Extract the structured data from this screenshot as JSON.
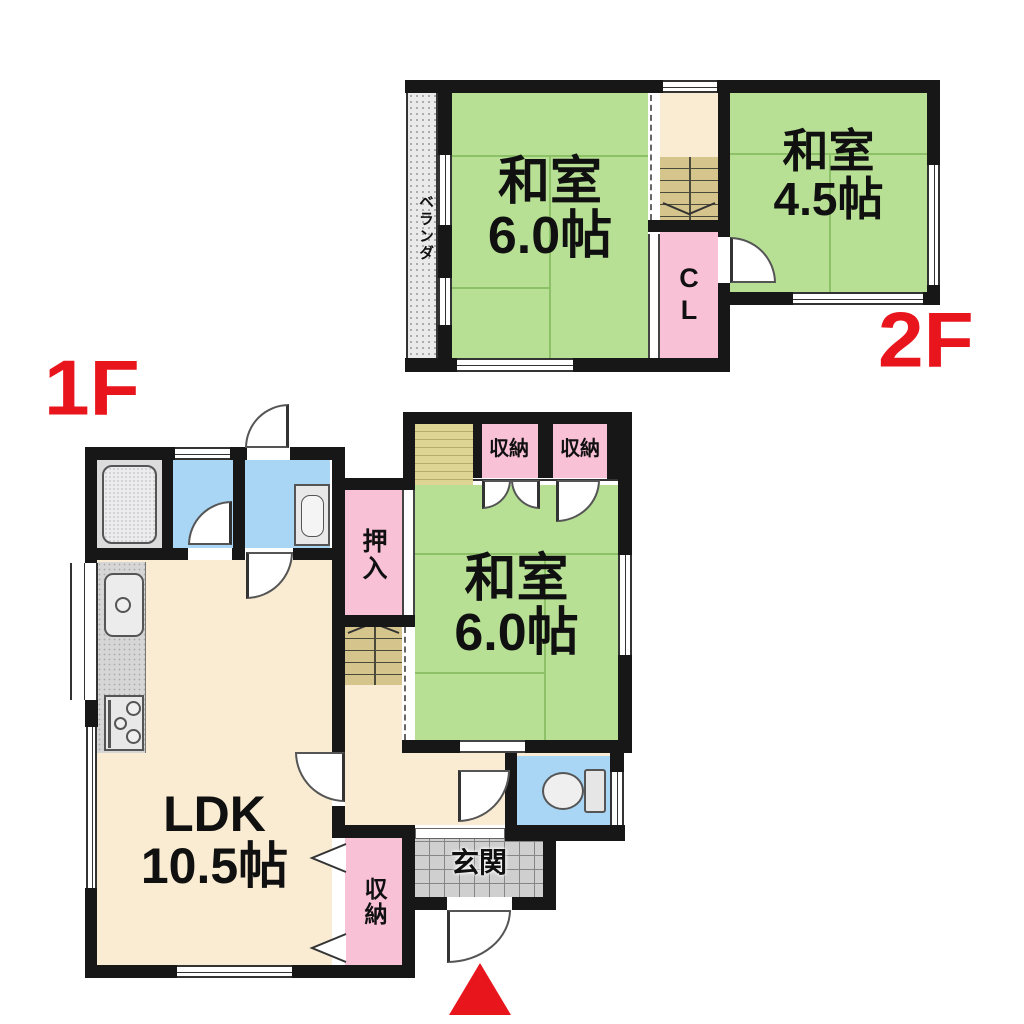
{
  "title": "戸建て間取り図 (detached house floor plan)",
  "floor2": {
    "label": "2F",
    "washitsu6": {
      "name": "和室",
      "size": "6.0帖"
    },
    "washitsu45": {
      "name": "和室",
      "size": "4.5帖"
    },
    "closet_label": "CL",
    "veranda_label": "ベランダ"
  },
  "floor1": {
    "label": "1F",
    "ldk": {
      "name": "LDK",
      "size": "10.5帖"
    },
    "washitsu6": {
      "name": "和室",
      "size": "6.0帖"
    },
    "oshiire_label": "押入",
    "storage_top_left": "収納",
    "storage_top_right": "収納",
    "storage_ldk": "収納",
    "genkan_label": "玄関"
  },
  "colors": {
    "accent_red": "#e8151d",
    "tatami_green": "#b7e095",
    "closet_pink": "#f9c1d6",
    "floor_beige": "#f9ecd2",
    "water_blue": "#a9d6f5",
    "stair_tan": "#d5c48b",
    "wood_khaki": "#ded594",
    "tile_gray": "#cfcfcf",
    "veranda_gray": "#eaeaea",
    "wall_black": "#171717"
  },
  "icons": {
    "bathtub": "bathtub-icon",
    "vanity": "vanity-icon",
    "toilet": "toilet-icon",
    "kitchen_sink": "kitchen-sink-icon",
    "stove": "stove-icon",
    "stairs": "stairs-icon",
    "entrance_arrow": "entrance-arrow-icon",
    "door_swing": "door-swing-icon",
    "sliding_door": "sliding-door-icon",
    "folding_door": "folding-door-icon"
  }
}
